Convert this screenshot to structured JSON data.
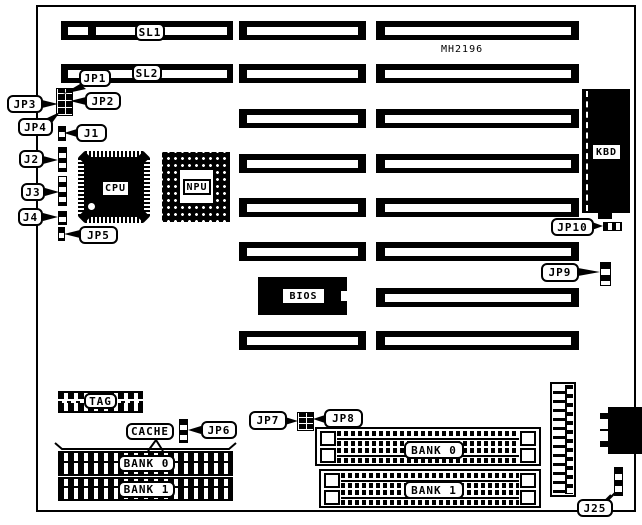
{
  "title": "MH2196",
  "slots": {
    "sl1": "SL1",
    "sl2": "SL2"
  },
  "chips": {
    "cpu": "CPU",
    "npu": "NPU",
    "bios": "BIOS",
    "kbd": "KBD"
  },
  "jumpers": {
    "jp1": "JP1",
    "jp2": "JP2",
    "jp3": "JP3",
    "jp4": "JP4",
    "jp5": "JP5",
    "jp6": "JP6",
    "jp7": "JP7",
    "jp8": "JP8",
    "jp9": "JP9",
    "jp10": "JP10",
    "j1": "J1",
    "j2": "J2",
    "j3": "J3",
    "j4": "J4",
    "j25": "J25"
  },
  "memory": {
    "tag": "TAG",
    "cache": "CACHE",
    "bank0_left": "BANK 0",
    "bank1_left": "BANK 1",
    "bank0_right": "BANK 0",
    "bank1_right": "BANK 1"
  },
  "colors": {
    "ink": "#000000",
    "paper": "#ffffff"
  }
}
